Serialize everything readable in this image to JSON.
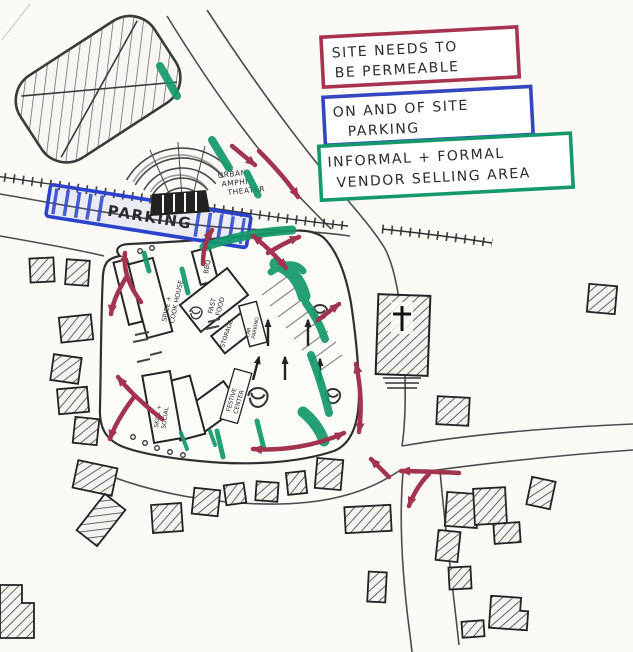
{
  "sketch": {
    "legend": [
      {
        "id": "permeable",
        "color": "#a83350",
        "lines": [
          "SITE NEEDS TO",
          "BE PERMEABLE"
        ]
      },
      {
        "id": "parking",
        "color": "#3547c0",
        "lines": [
          "ON AND OF SITE",
          "PARKING"
        ]
      },
      {
        "id": "vendor",
        "color": "#13996a",
        "lines": [
          "INFORMAL + FORMAL",
          "VENDOR SELLING AREA"
        ]
      }
    ],
    "labels": {
      "parking_strip": "PARKING",
      "amphitheater": [
        "URBAN",
        "AMPHI-",
        "THEATER"
      ],
      "buildings": {
        "spice_cook": [
          "SPICE +",
          "COOK HOUSE"
        ],
        "bbq": "BBQ",
        "fast_food": [
          "FAST",
          "FOOD"
        ],
        "storage": "STORAGE",
        "car_parking": [
          "CAR",
          "PARKING"
        ],
        "festive_center": [
          "FESTIVE",
          "CENTER"
        ],
        "skill_social": [
          "SKILL +",
          "SOCIAL"
        ]
      }
    },
    "colors": {
      "ink": "#2e2e2e",
      "red_marker": "#a23450",
      "blue_marker": "#2b43cc",
      "green_marker": "#13996a",
      "paper": "#fbfaf7"
    }
  }
}
